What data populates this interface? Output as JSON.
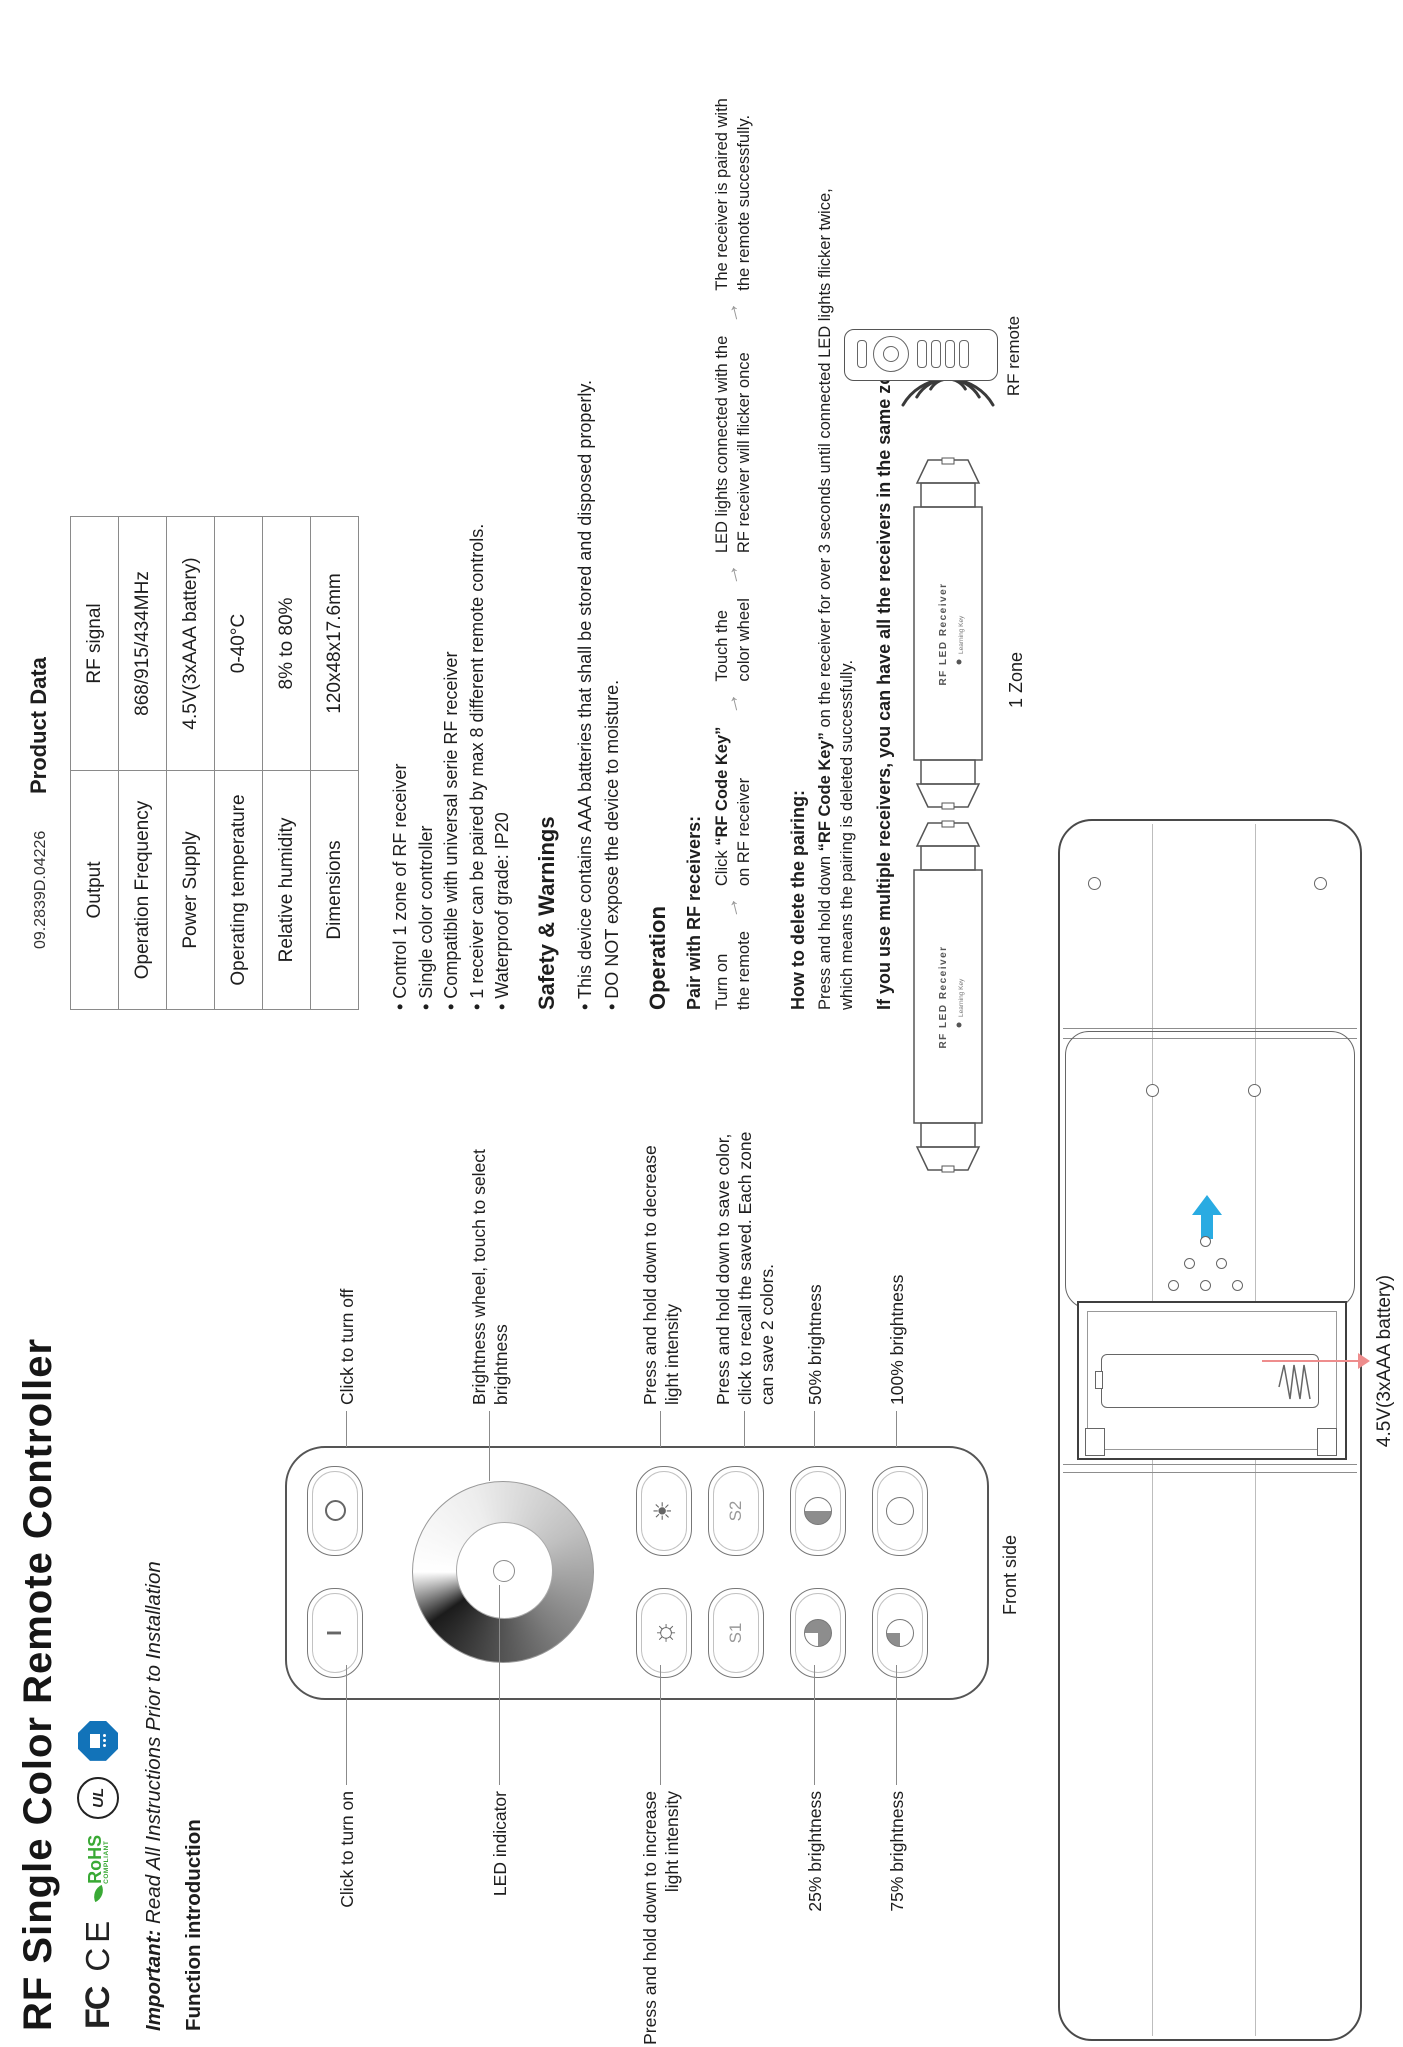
{
  "title": "RF Single Color Remote Controller",
  "doc_number": "09.2839D.04226",
  "notices": {
    "important_prefix": "Important:",
    "important_text": " Read All Instructions Prior to Installation",
    "function_heading": "Function introduction",
    "front_side": "Front side",
    "battery_note": "4.5V(3xAAA battery)"
  },
  "certifications": {
    "fcc": "FC",
    "ce": "CE",
    "rohs": "RoHS",
    "rohs_sub": "COMPLIANT",
    "ul": "UL"
  },
  "product_data": {
    "heading": "Product Data",
    "rows": [
      {
        "label": "Output",
        "value": "RF signal"
      },
      {
        "label": "Operation Frequency",
        "value": "868/915/434MHz"
      },
      {
        "label": "Power Supply",
        "value": "4.5V(3xAAA battery)"
      },
      {
        "label": "Operating temperature",
        "value": "0-40°C"
      },
      {
        "label": "Relative humidity",
        "value": "8% to 80%"
      },
      {
        "label": "Dimensions",
        "value": "120x48x17.6mm"
      }
    ]
  },
  "features": [
    "Control 1 zone of RF receiver",
    "Single color controller",
    "Compatible with universal serie RF receiver",
    "1 receiver can be paired by max 8 different remote controls.",
    "Waterproof grade: IP20"
  ],
  "safety": {
    "heading": "Safety & Warnings",
    "items": [
      "This device contains AAA batteries that shall be stored and disposed properly.",
      "DO NOT expose the device to moisture."
    ]
  },
  "operation": {
    "heading": "Operation",
    "pair_heading": "Pair with RF receivers:",
    "steps": [
      {
        "l1": "Turn on",
        "l2": "the remote"
      },
      {
        "l1_pre": "Click ",
        "l1_bold": "“RF Code Key”",
        "l2": "on RF receiver"
      },
      {
        "l1": "Touch the",
        "l2": "color wheel"
      },
      {
        "l1": "LED lights connected with the",
        "l2": "RF receiver will flicker once"
      },
      {
        "l1": "The receiver is paired with",
        "l2": "the remote successfully."
      }
    ],
    "delete_heading": "How to delete the pairing:",
    "delete_line1_pre": "Press and hold down ",
    "delete_line1_bold": "“RF Code Key”",
    "delete_line1_post": " on the receiver for over 3 seconds until connected LED lights flicker twice,",
    "delete_line2": "which means the pairing is deleted successfully.",
    "multi_note": "If you use multiple receivers, you can have all the receivers in the same zone"
  },
  "zone_diagram": {
    "receiver_text": "RF LED Receiver",
    "learning_key": "Learning Key",
    "zone_label": "1 Zone",
    "remote_label": "RF remote"
  },
  "remote": {
    "buttons": {
      "s1": "S1",
      "s2": "S2"
    },
    "callouts_left": [
      {
        "lines": [
          "Click to turn on"
        ]
      },
      {
        "lines": [
          "LED indicator"
        ]
      },
      {
        "lines": [
          "Press and hold down to increase",
          "light intensity"
        ]
      },
      {
        "lines": [
          "25% brightness"
        ]
      },
      {
        "lines": [
          "75% brightness"
        ]
      }
    ],
    "callouts_right": [
      {
        "lines": [
          "Click to turn off"
        ]
      },
      {
        "lines": [
          "Brightness wheel, touch to select",
          "brightness"
        ]
      },
      {
        "lines": [
          "Press and hold down to decrease",
          "light intensity"
        ]
      },
      {
        "lines": [
          "Press and hold down to save color,",
          "click to recall the saved. Each zone",
          "can save 2 colors."
        ]
      },
      {
        "lines": [
          "50% brightness"
        ]
      },
      {
        "lines": [
          "100% brightness"
        ]
      }
    ]
  },
  "icons": {
    "flow_arrow": "→",
    "sun_increase": "☼",
    "sun_decrease": "☀",
    "power_on": "I"
  },
  "colors": {
    "accent_blue": "#29abe2",
    "arrow_red": "#ee8d8d",
    "rohs_green": "#39a935",
    "tuv_blue": "#1273b9",
    "text": "#1e1e1e"
  }
}
